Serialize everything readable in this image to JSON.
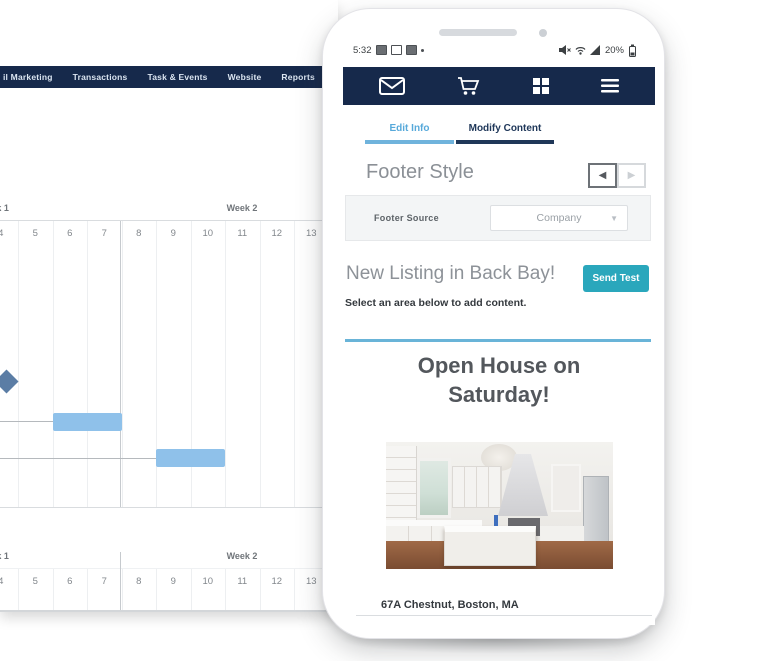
{
  "desktop": {
    "nav": {
      "items": [
        "il Marketing",
        "Transactions",
        "Task & Events",
        "Website",
        "Reports"
      ]
    },
    "gantt": {
      "week_labels": [
        "Week 1",
        "Week 2"
      ],
      "days": [
        "4",
        "5",
        "6",
        "7",
        "8",
        "9",
        "10",
        "11",
        "12",
        "13"
      ],
      "milestone": {
        "day": 4
      },
      "bars": [
        {
          "start_day": 6,
          "end_day": 7
        },
        {
          "start_day": 9,
          "end_day": 10
        }
      ],
      "bar_color": "#8fc1ea",
      "milestone_color": "#5b7da5"
    }
  },
  "phone": {
    "status": {
      "time": "5:32",
      "battery": "20%"
    },
    "icons": {
      "appbar": [
        "envelope",
        "shopping-cart",
        "apps-grid",
        "menu"
      ],
      "status_left": [
        "image",
        "vibrate",
        "sd-card",
        "dot"
      ],
      "status_right": [
        "mute",
        "wifi",
        "signal",
        "battery"
      ],
      "pager": [
        "prev-arrow",
        "next-arrow"
      ],
      "dropdown_caret": "caret-down"
    },
    "tabs": [
      {
        "label": "Edit Info"
      },
      {
        "label": "Modify Content"
      }
    ],
    "active_tab": "Modify Content",
    "footer_style": {
      "heading": "Footer Style",
      "field_label": "Footer Source",
      "field_value": "Company"
    },
    "listing": {
      "heading": "New Listing in Back Bay!",
      "button": "Send Test",
      "hint": "Select an area below to add content."
    },
    "email": {
      "headline": "Open House on Saturday!",
      "address": "67A Chestnut, Boston, MA"
    }
  },
  "colors": {
    "navy": "#16294b",
    "teal_button": "#2aa7bc",
    "tab_blue": "#57a9da",
    "tab_dark": "#1f3758",
    "divider_blue": "#69b4d8",
    "gantt_bar": "#8fc1ea",
    "gantt_milestone": "#5b7da5"
  }
}
